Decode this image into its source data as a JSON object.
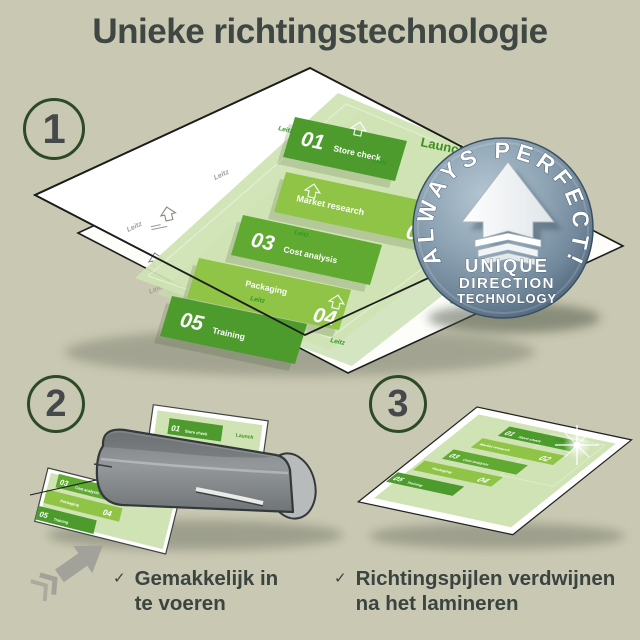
{
  "title": "Unieke richtingstechnologie",
  "steps": [
    "1",
    "2",
    "3"
  ],
  "badge": {
    "arc_text": "ALWAYS PERFECT!",
    "line1": "UNIQUE",
    "line2": "DIRECTION",
    "line3": "TECHNOLOGY"
  },
  "document": {
    "launch_label": "Launch",
    "watermark": "Leitz",
    "bands": [
      {
        "number": "01",
        "label": "Store check"
      },
      {
        "number": "02",
        "label": "Market research"
      },
      {
        "number": "03",
        "label": "Cost analysis"
      },
      {
        "number": "04",
        "label": "Packaging"
      },
      {
        "number": "05",
        "label": "Training"
      }
    ]
  },
  "captions": {
    "step2": {
      "check": "✓",
      "line1": "Gemakkelijk in",
      "line2": "te voeren"
    },
    "step3": {
      "check": "✓",
      "line1": "Richtingspijlen verdwijnen",
      "line2": "na het lamineren"
    }
  },
  "colors": {
    "background": "#c9c8b2",
    "title_text": "#3e4743",
    "step_ring": "#2c4a26",
    "band_dark": "#4c9b2c",
    "band_mid": "#60aa32",
    "band_light": "#8fc447",
    "sheet_green": "#cfe3b4",
    "launch_green": "#3f8f22",
    "badge_steel": "#7e95a7",
    "laminator_gray": "#8a8e90",
    "caption_text": "#3a4440"
  }
}
